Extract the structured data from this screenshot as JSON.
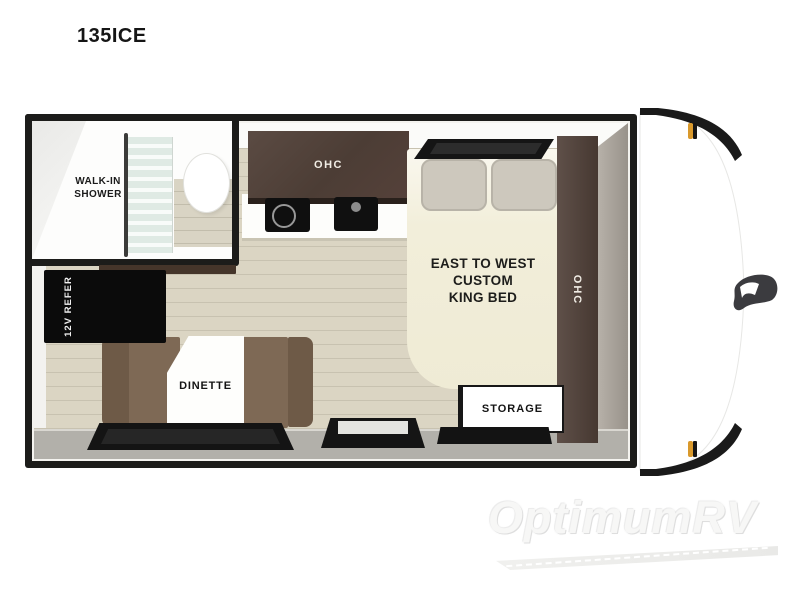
{
  "title": "135ICE",
  "rooms": {
    "bathroom": {
      "shower_lines": [
        "WALK-IN",
        "SHOWER"
      ]
    },
    "kitchen": {
      "ohc_label": "OHC"
    },
    "bedroom": {
      "bed_lines": [
        "EAST TO WEST",
        "CUSTOM",
        "KING BED"
      ],
      "ohc_label": "OHC",
      "storage_label": "STORAGE"
    },
    "dinette": {
      "label": "DINETTE",
      "refrigerator_label": "12V REFER"
    }
  },
  "watermark": {
    "brand": "OptimumRV"
  },
  "colors": {
    "frame_black": "#1c1c1a",
    "cabinet_wood": "#4f4038",
    "floor_plank": "#d9d3c1",
    "dinette_brown": "#7e6955",
    "bed_cream": "#f1edda",
    "bottom_wall_gray": "#b2b0aa",
    "marker_amber": "#d9992c"
  }
}
